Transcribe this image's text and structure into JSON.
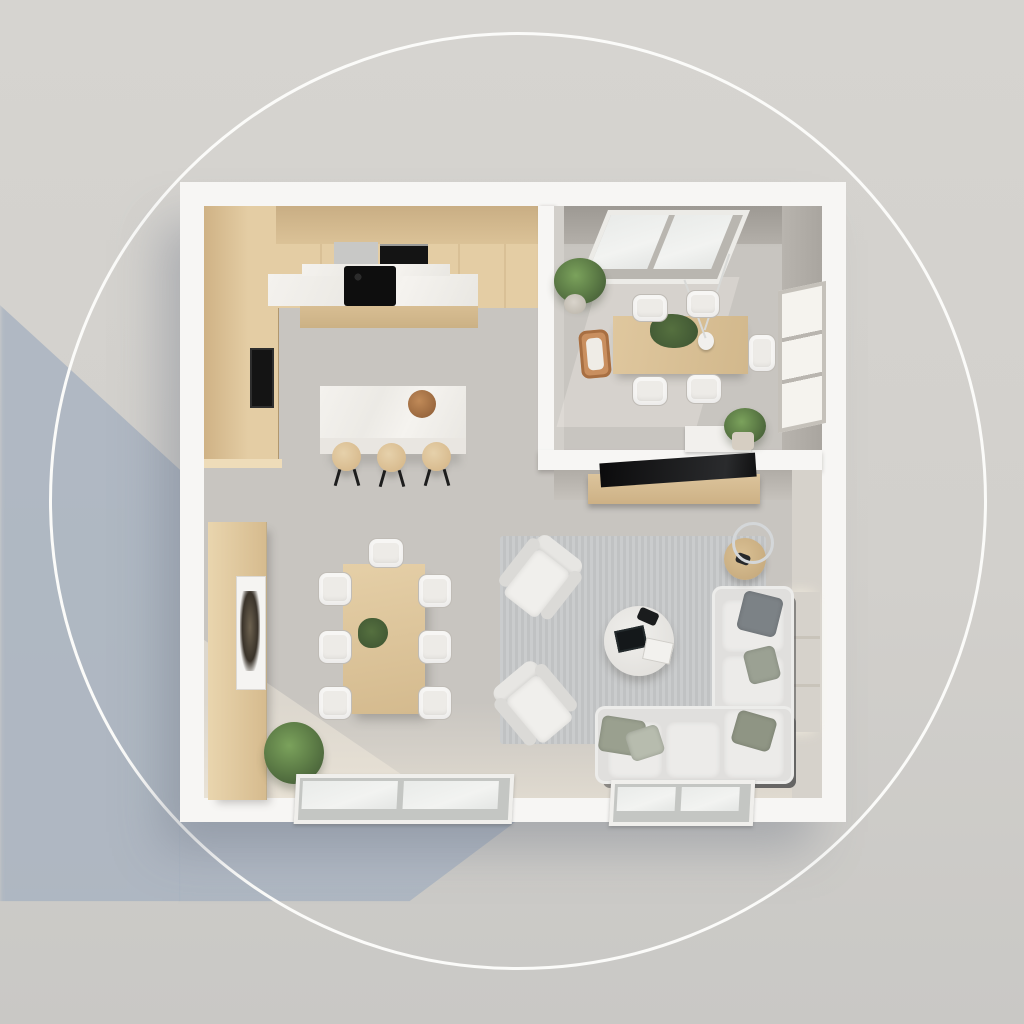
{
  "scene": {
    "kind": "top-down-3d-floorplan-render",
    "decor": {
      "circle_outline": true,
      "cast_shadow_direction": "lower-left"
    },
    "rooms": [
      "kitchen",
      "dining-room",
      "living-room",
      "dining-area"
    ]
  },
  "colors": {
    "background_top": "#d6d4d0",
    "background_bottom": "#c9c8c5",
    "shadow": "#aab4c1",
    "circle": "#fbfbf9",
    "wall": "#f7f6f4",
    "wall_face": "#aba79f",
    "floor": "#c8c5c0",
    "wood": "#e4cda4",
    "wood_dark": "#cfb285",
    "marble": "#f2f0ec",
    "appliance_black": "#141414",
    "rug": "#c6c8c9",
    "sofa": "#e0dfdd",
    "chair": "#edebe7",
    "glass": "#f5f3ee",
    "green": "#5f7f48",
    "green_dark": "#3c5231",
    "wood_chair": "#c98f5f"
  },
  "kitchen": {
    "items": [
      "upper-cabinets",
      "tall-cabinet-column",
      "built-in-oven",
      "cooktop",
      "marble-counter",
      "kitchen-island",
      "fruit-bowl"
    ],
    "cooktop_burners": 4,
    "island_stools": 3
  },
  "dining_room": {
    "items": [
      "skylight-window",
      "side-window",
      "corner-plant",
      "dining-table",
      "pendant-lamp",
      "console",
      "console-plant"
    ],
    "chairs": 6,
    "skylight_panes": 2
  },
  "living_room": {
    "items": [
      "tv-console",
      "tv",
      "rug",
      "sectional-sofa",
      "coffee-table",
      "side-table",
      "floor-lamp",
      "wall-window"
    ],
    "armchairs": 2,
    "sofa_pillows": 5,
    "sofa_seat_cushions": 5,
    "coffee_table_books": 2
  },
  "dining_area": {
    "items": [
      "sideboard",
      "framed-artwork",
      "floor-plant",
      "dining-table",
      "table-plant"
    ],
    "chairs": 7
  },
  "openings": {
    "floor_window_left_panes": 2,
    "floor_window_right_panes": 2
  }
}
